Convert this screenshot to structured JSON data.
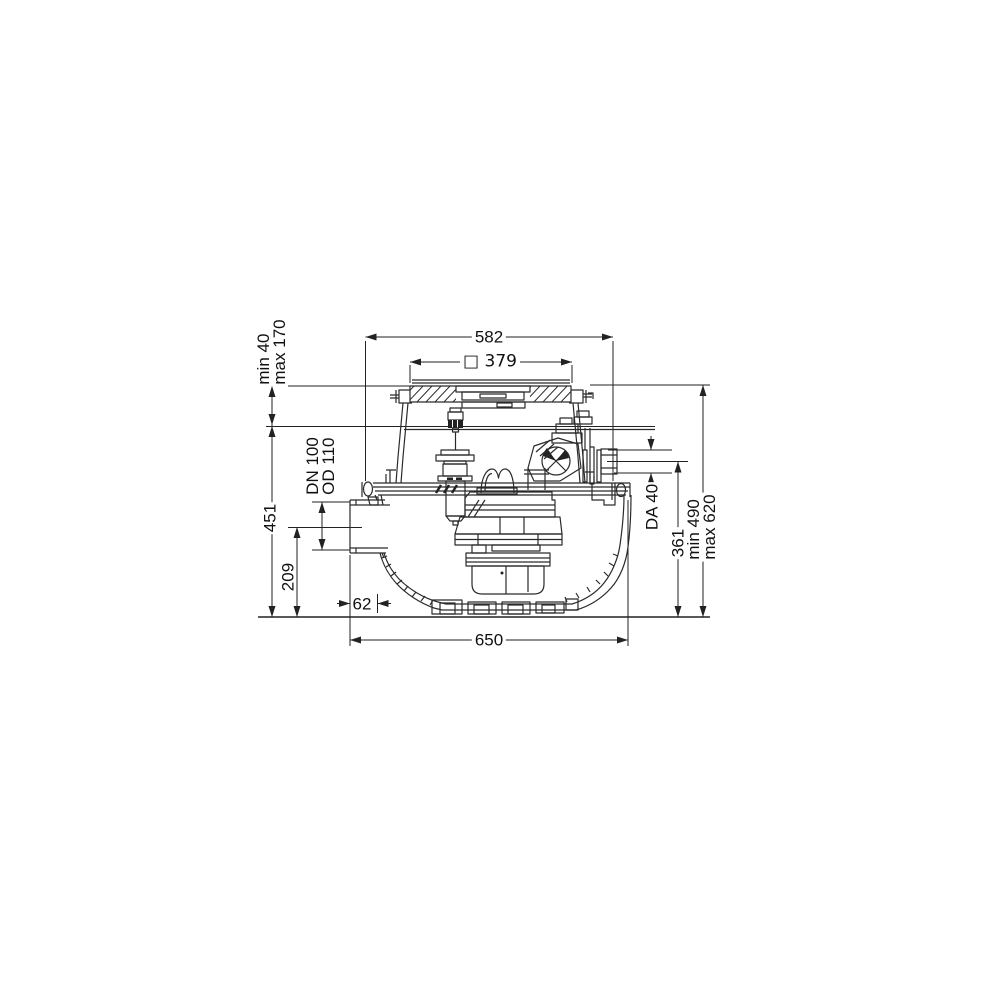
{
  "drawing": {
    "line_color": "#2a2a2a",
    "dimensions": {
      "top_width": "582",
      "cover_square": "□ 379",
      "cover_adjust_line1": "min 40",
      "cover_adjust_line2": "max 170",
      "body_height": "451",
      "inlet_line1": "DN 100",
      "inlet_line2": "OD 110",
      "inlet_axis_height": "209",
      "inlet_face_offset": "62",
      "base_width": "650",
      "outlet_label": "DA 40",
      "outlet_axis_height": "361",
      "total_height_line1": "min 490",
      "total_height_line2": "max 620"
    }
  }
}
